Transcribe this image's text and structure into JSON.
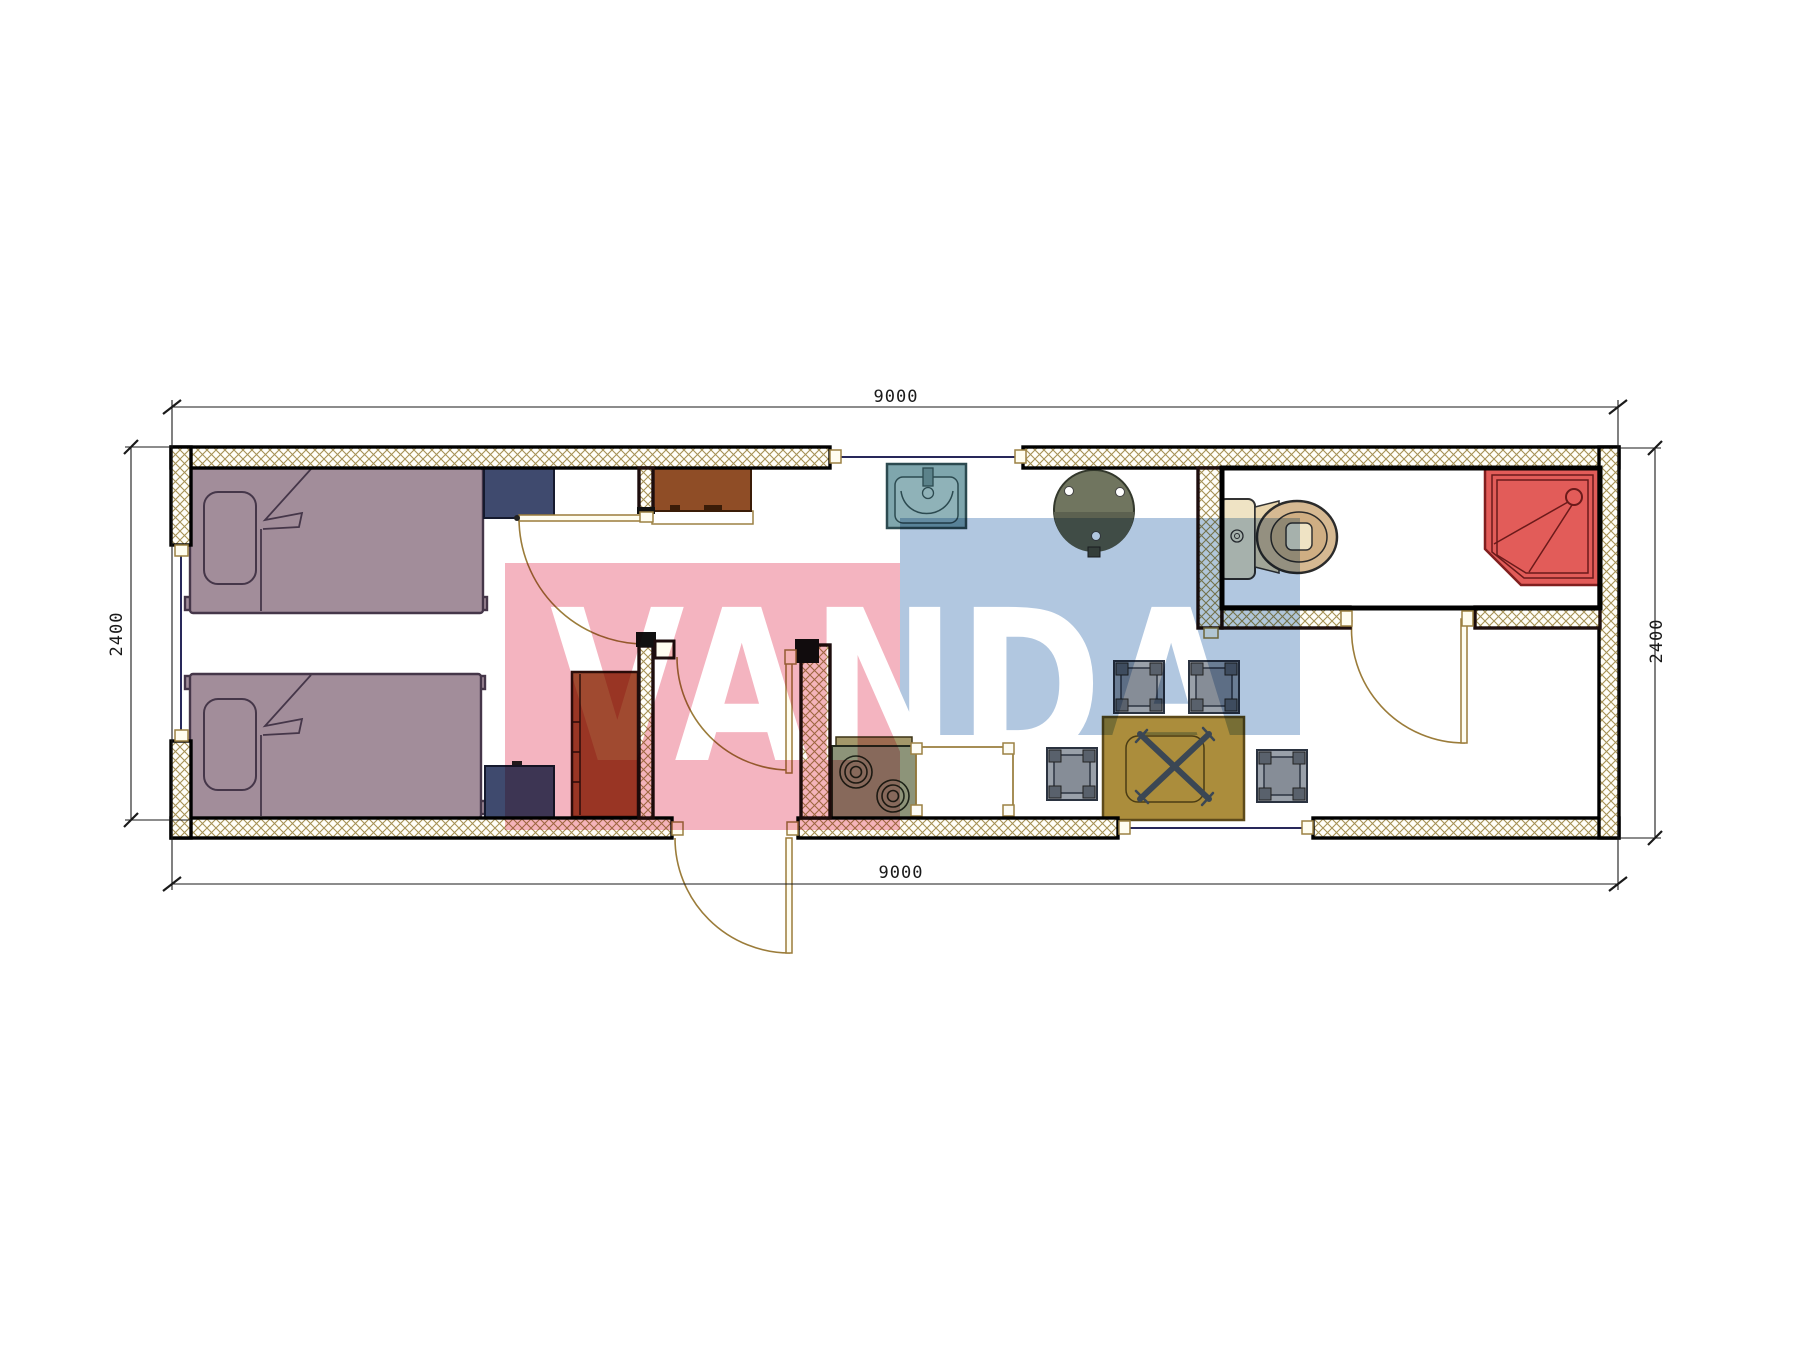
{
  "dimensions": {
    "top_width": "9000",
    "bottom_width": "9000",
    "left_height": "2400",
    "right_height": "2400"
  },
  "watermark": {
    "text": "VANDA",
    "pink_block": "#f4b4c0",
    "blue_block": "#b1c7e0"
  },
  "palette": {
    "bed-mauve": "#a28d9a",
    "navy": "#3f4a6e",
    "wardrobe-red": "#a04a30",
    "cabinet-brown": "#8f4d26",
    "stove-sage": "#8d9479",
    "sink-teal": "#7fa6ad",
    "olive-table": "#70755f",
    "gold-table": "#ab8d3c",
    "stool-gray": "#99a0a9",
    "toilet-beige": "#d6b992",
    "shower-red": "#e25c59",
    "wm-pink": "#f4b4c0",
    "wm-blue": "#b1c7e0",
    "hatch-line": "#a59155"
  }
}
